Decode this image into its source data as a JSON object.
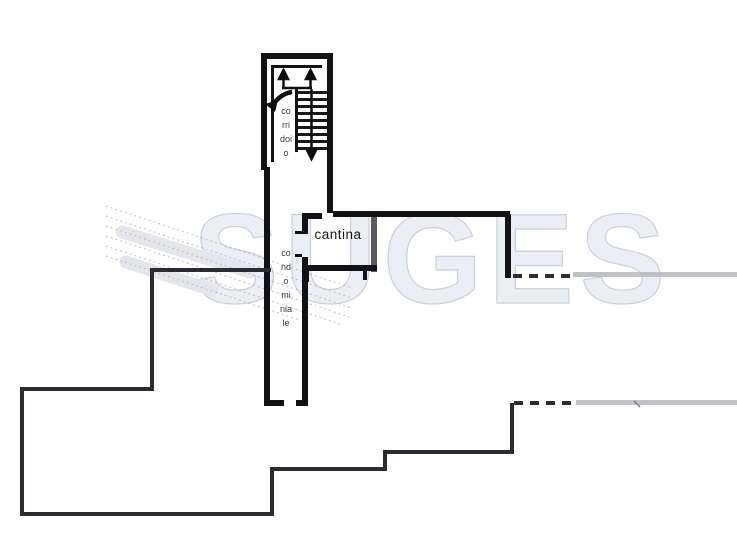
{
  "watermark": {
    "text": "SUGES"
  },
  "rooms": {
    "cantina_label": "cantina",
    "corridor_word1": "corridoio",
    "corridor_word2": "condominiale"
  },
  "colors": {
    "paper": "#ffffff",
    "wall_dark": "#121216",
    "wall_medium": "#2b2b33",
    "wall_gray": "#5a5a63",
    "edge_gray": "#b6b7c0",
    "watermark_stroke": "#ccd0da",
    "label_text": "#17171a"
  }
}
